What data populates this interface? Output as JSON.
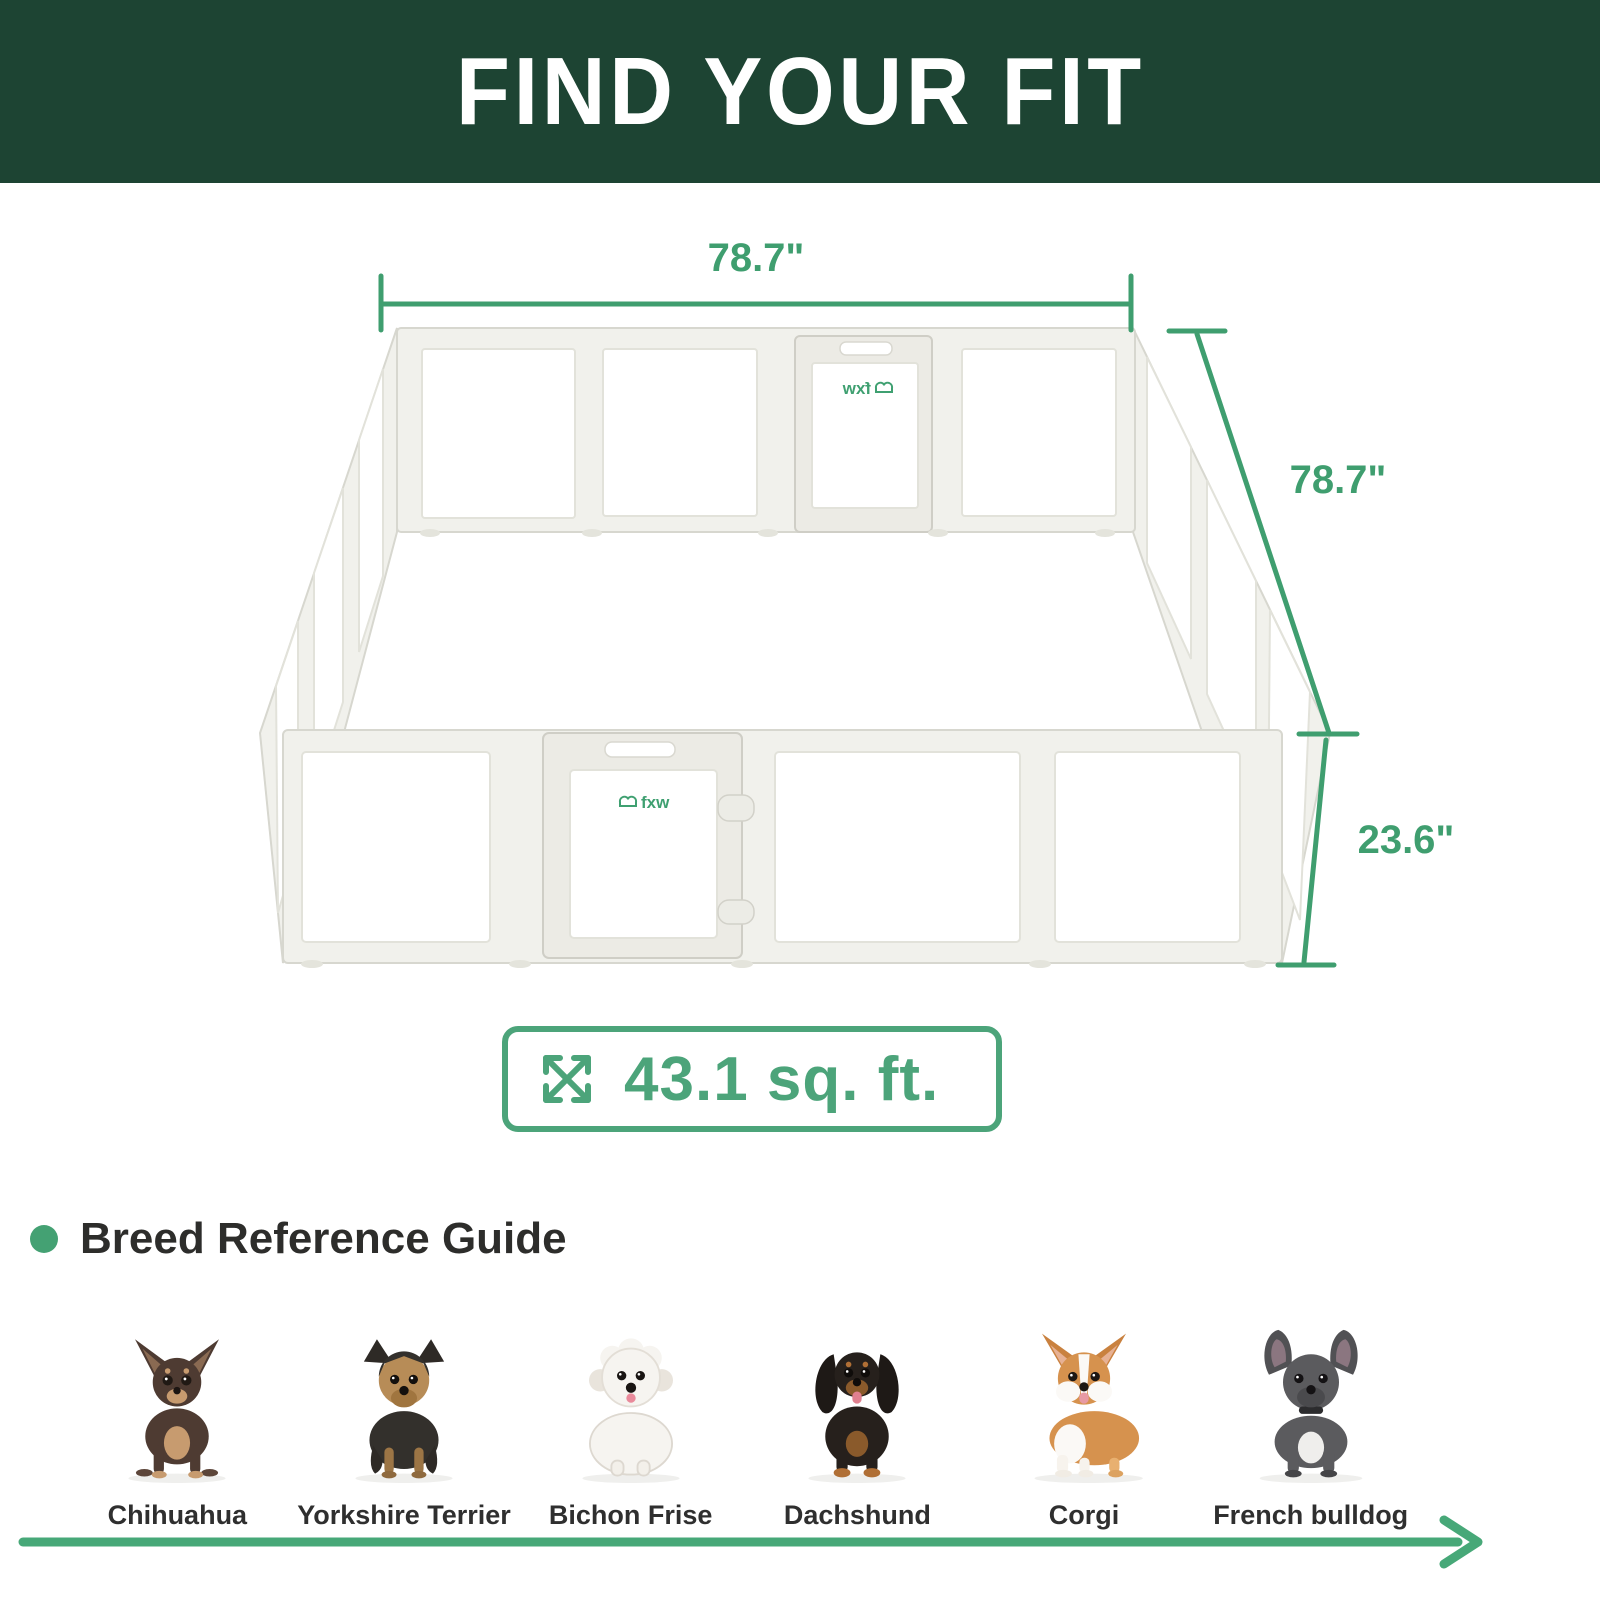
{
  "banner": {
    "title": "FIND YOUR FIT"
  },
  "diagram": {
    "width_label": "78.7\"",
    "depth_label": "78.7\"",
    "height_label": "23.6\"",
    "area_value": "43.1 sq. ft.",
    "brand_logo": "fxw"
  },
  "breeds": {
    "heading": "Breed Reference Guide",
    "items": [
      {
        "label": "Chihuahua"
      },
      {
        "label": "Yorkshire Terrier"
      },
      {
        "label": "Bichon Frise"
      },
      {
        "label": "Dachshund"
      },
      {
        "label": "Corgi"
      },
      {
        "label": "French bulldog"
      }
    ]
  },
  "colors": {
    "banner_bg": "#1d4433",
    "accent_green": "#3f9e6f",
    "badge_green": "#4ca47a",
    "heading_text": "#2d2d2b"
  }
}
